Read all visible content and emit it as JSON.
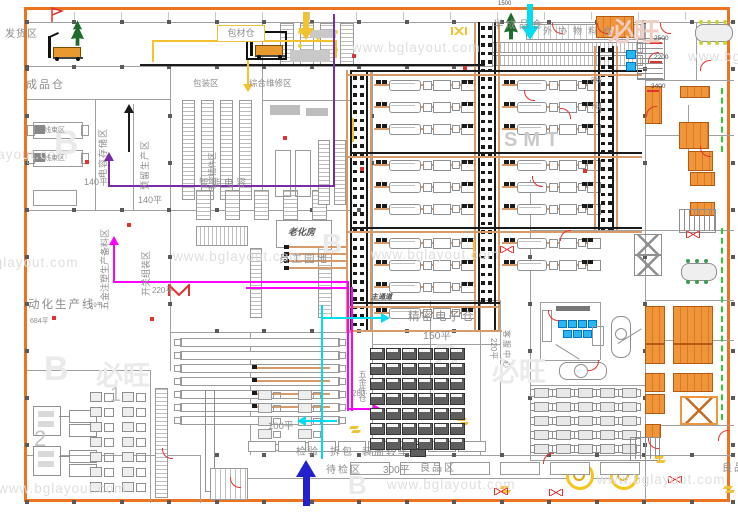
{
  "app": {
    "type": "factory-floor-plan-cad-drawing"
  },
  "colors": {
    "border_orange": "#EC7320",
    "wall_gray": "#A0A0A0",
    "label_gray": "#8C8C8C",
    "conveyor_tan": "#D79B6B",
    "route_black": "#1A1A1A",
    "route_yellow": "#F2C230",
    "route_magenta": "#FF00FF",
    "route_cyan": "#00DCF0",
    "route_purple": "#7A2BA8",
    "route_blue": "#2222CC",
    "alert_red": "#E53030",
    "desk_orange": "#F0953A",
    "green_dash": "#2FCB2F",
    "tree_green": "#1E6B2E",
    "watermark_gray": "#DEDEDE"
  },
  "labels": {
    "shipping": "发货区",
    "finished_goods": "成品仓",
    "packing_material": "包材仓",
    "packing_area": "包装区",
    "maintenance": "综合维修区",
    "capacitor_storage": "电容存储区",
    "area_140": "140平",
    "reserved_production": "预留生产区",
    "wire_area": "线束区",
    "semi_finished": "半成品仓",
    "outsourced_material": "外协物料仓",
    "smt": "SMT",
    "line8": "8线",
    "line7": "7线",
    "smart_capacitor": "智能电容",
    "capacitor_plugin": "电容插件区",
    "hardware_prep": "五金注塑生产备料区",
    "area_19": "19平",
    "switch_assembly": "开关组装区",
    "area_220": "220平",
    "aging_room": "老化房",
    "staff_garden": "员工园地",
    "auto_line": "动化生产线",
    "area_684": "684平",
    "main_aisle": "主通道",
    "precision_warehouse": "精密电子仓",
    "area_150": "150平",
    "hardware_warehouse": "五金件仓",
    "area_280": "280平",
    "area_100": "100平",
    "inspection": "检验",
    "unpacking": "拆包",
    "trolley": "装周转车",
    "pending_inspection": "待检区",
    "area_300": "300平",
    "good_products": "良品区",
    "service_center": "客服中心",
    "dim_2500": "2500",
    "dim_2200": "2200",
    "dim_3400": "3400",
    "dim_1500": "1500",
    "line_no_1": "1",
    "line_no_2": "2",
    "watermark": "www.bglayout.com",
    "logo_b": "B",
    "logo_brand": "必旺"
  }
}
